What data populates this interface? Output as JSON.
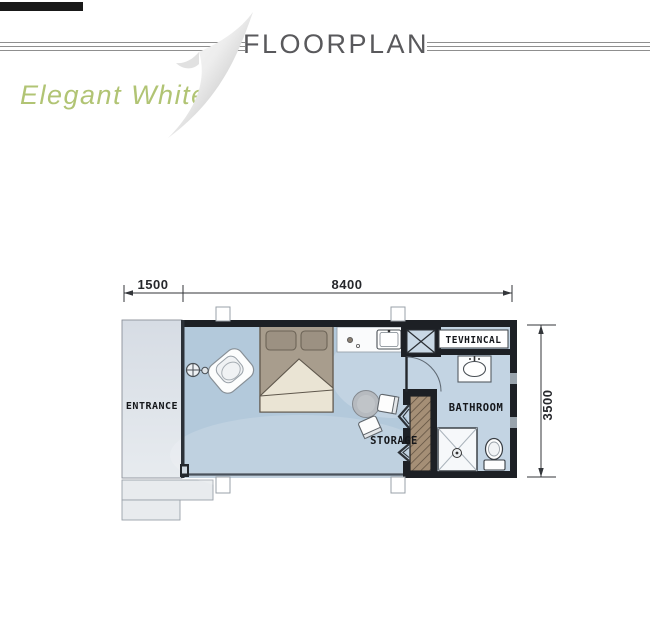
{
  "header": {
    "title": "FLOORPLAN",
    "variant_label": "Elegant White"
  },
  "plan": {
    "labels": {
      "entrance": "ENTRANCE",
      "technical": "TEVHINCAL",
      "bathroom": "BATHROOM",
      "storage": "STORAGE"
    },
    "dimensions": {
      "entrance_width": "1500",
      "module_width": "8400",
      "module_depth": "3500"
    }
  },
  "colors": {
    "accent_green": "#b1c474",
    "title_gray": "#59595c",
    "wall": "#1d2025",
    "floor_blue": "#b3c9db",
    "bathroom_blue": "#c3d4e3",
    "bed_taupe": "#a89d8d",
    "wardrobe_tan": "#a58f76"
  }
}
